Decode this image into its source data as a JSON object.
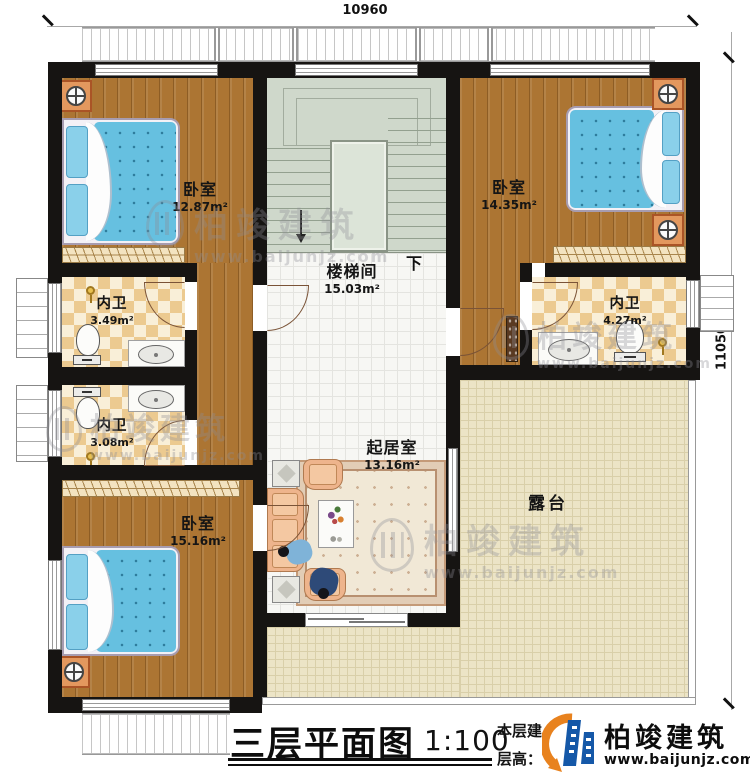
{
  "plan": {
    "dimension_top": "10960",
    "dimension_right": "11050",
    "stair_down_label": "下"
  },
  "rooms": {
    "bedroom_tl": {
      "label": "卧室",
      "area": "12.87m²"
    },
    "stairwell": {
      "label": "楼梯间",
      "area": "15.03m²"
    },
    "bedroom_tr": {
      "label": "卧室",
      "area": "14.35m²"
    },
    "bath_left_upper": {
      "label": "内卫",
      "area": "3.49m²"
    },
    "bath_left_lower": {
      "label": "内卫",
      "area": "3.08m²"
    },
    "bath_right": {
      "label": "内卫",
      "area": "4.27m²"
    },
    "bedroom_bl": {
      "label": "卧室",
      "area": "15.16m²"
    },
    "living": {
      "label": "起居室",
      "area": "13.16m²"
    },
    "terrace": {
      "label": "露台"
    }
  },
  "titleblock": {
    "title": "三层平面图",
    "scale": "1:100",
    "info_line1": "本层建筑面积",
    "info_line2": "层高：",
    "brand_name": "柏竣建筑",
    "brand_url": "www.baijunjz.com"
  },
  "watermark": {
    "name": "柏竣建筑",
    "url": "www.baijunjz.com"
  },
  "colors": {
    "wall": "#161412",
    "wood": "#ac7533",
    "stair_floor": "#cfd8cb",
    "living_tile": "#f7f7f4",
    "terrace_floor": "#ece4c6",
    "bath_check_a": "#ecca90",
    "bath_check_b": "#f9efd8",
    "bed_blue": "#66c0e0",
    "nightstand_orange": "#e3985e",
    "brand_blue": "#1558a8",
    "brand_orange": "#e8821e"
  }
}
